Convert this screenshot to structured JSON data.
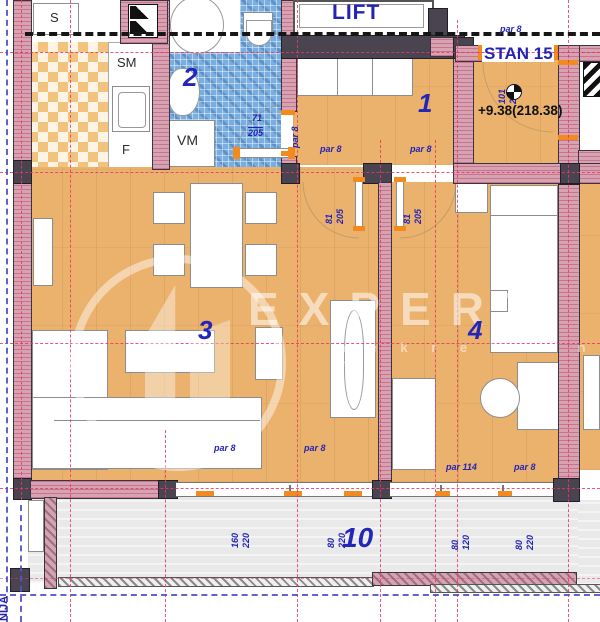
{
  "labels": {
    "lift": "LIFT",
    "stan": "STAN 15",
    "elevation": "+9.38(218.38)",
    "nija": "NIJA",
    "s": "S",
    "sm": "SM",
    "f": "F",
    "vm": "VM",
    "r1": "1",
    "r2": "2",
    "r3": "3",
    "r4": "4",
    "r10": "10"
  },
  "dims": {
    "par8": "par 8",
    "par114": "par 114",
    "n81": "81",
    "n205": "205",
    "n101": "101",
    "n71": "71",
    "n160": "160",
    "n220": "220",
    "n80": "80",
    "n120": "120"
  },
  "watermark": {
    "brand": "EXPERT",
    "sub": "n e k r e t n i n e"
  },
  "colors": {
    "accent_blue": "#2424b4",
    "wall_pink": "#d7a2b2",
    "wood": "#ebb26e",
    "tile_blue": "#79aede",
    "door_orange": "#f28a1e",
    "axis_red": "#e23a68",
    "boundary_blue": "#5252c8"
  }
}
